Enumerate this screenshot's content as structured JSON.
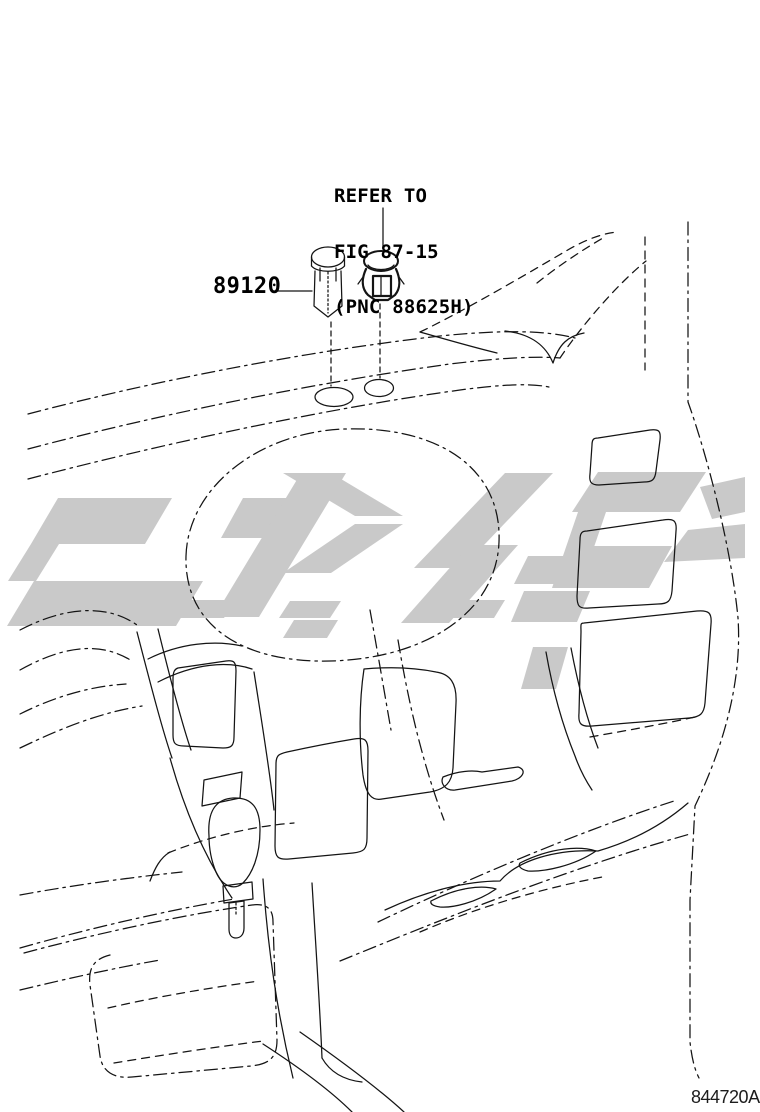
{
  "colors": {
    "line": "#141414",
    "watermark": "#c9c9c9",
    "text": "#000000",
    "background": "#ffffff"
  },
  "callouts": {
    "part_number": "89120",
    "refer_note": {
      "line1": "REFER TO",
      "line2": "FIG 87-15",
      "line3": "(PNC 88625H)"
    },
    "diagram_code": "844720A"
  },
  "icons": {
    "part_89120": "push-in-sensor-plug-icon",
    "referenced_part": "retainer-clip-icon",
    "watermark": "angular-script-watermark"
  }
}
